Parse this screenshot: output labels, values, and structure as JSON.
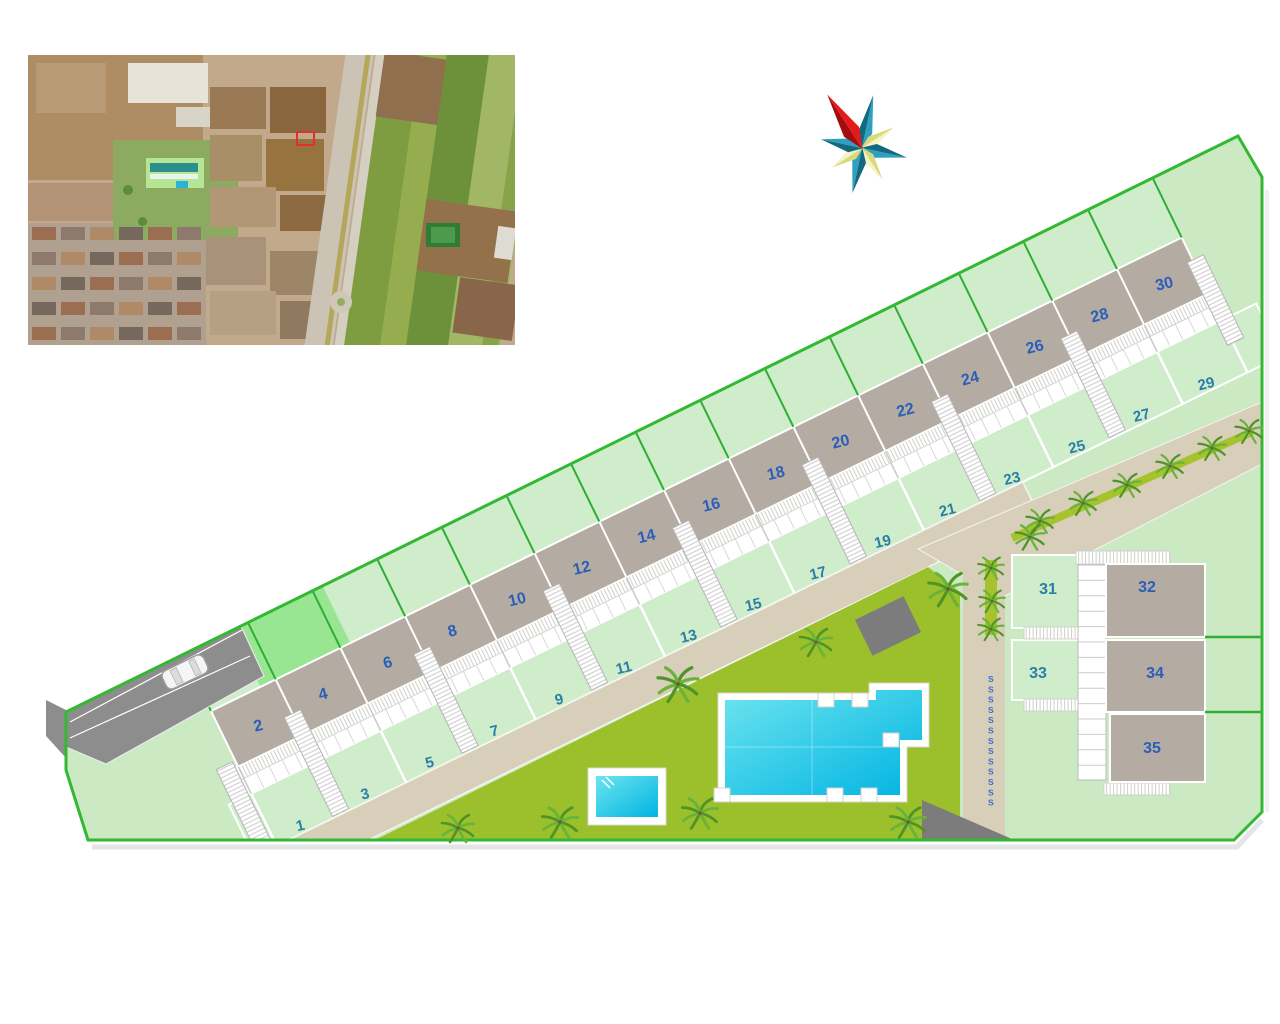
{
  "site_plan": {
    "roof_numbers": [
      "2",
      "4",
      "6",
      "8",
      "10",
      "12",
      "14",
      "16",
      "18",
      "20",
      "22",
      "24",
      "26",
      "28",
      "30"
    ],
    "garden_numbers": [
      "1",
      "3",
      "5",
      "7",
      "9",
      "11",
      "13",
      "15",
      "17",
      "19",
      "21",
      "23",
      "25",
      "27",
      "29"
    ],
    "right_block": {
      "garden_numbers": [
        "31",
        "33"
      ],
      "building_numbers": [
        "32",
        "34",
        "35"
      ]
    },
    "fence_line": {
      "glyph": "S",
      "count": 13
    },
    "colors": {
      "parcel_fill": "#cbe9c2",
      "parcel_border": "#33b833",
      "inner_divider_green": "#2fae35",
      "roof": "#b4aba3",
      "garden": "#cfeccb",
      "bright_lawn": "#98e692",
      "communal_lawn": "#9cc02c",
      "road": "#d7cfba",
      "road_median": "#a6c32d",
      "driveway": "#8d8d8d",
      "pool_water_light": "#6ce4ef",
      "pool_water_dark": "#00b4e2",
      "building_number": "#2a5fb8",
      "garden_number": "#2a7fa6",
      "fence_marker_color": "#3a6fc4",
      "shed": "#7c7c7c",
      "palm_dark": "#4e9426",
      "palm_light": "#6ab33a",
      "compass_teal_dark": "#14697f",
      "compass_teal_light": "#2da0c0",
      "compass_yellow_dark": "#d9d97e",
      "compass_yellow_light": "#f4f4c4",
      "compass_red_dark": "#a30d0d",
      "compass_red_light": "#e51a1a"
    }
  }
}
